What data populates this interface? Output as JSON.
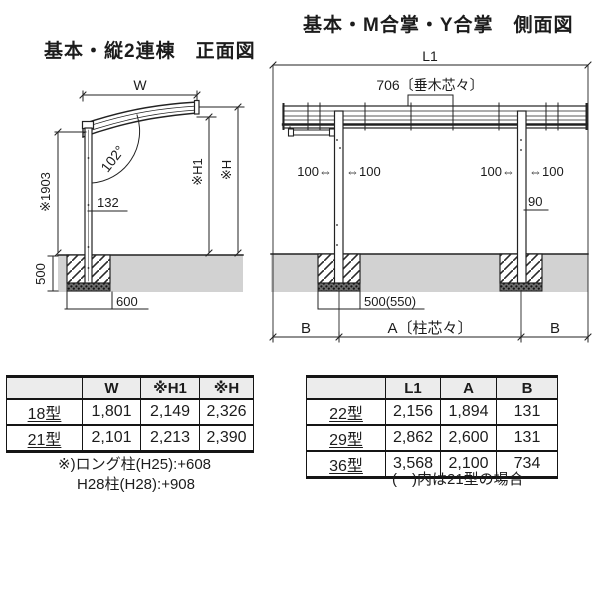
{
  "front_view": {
    "title": "基本・縦2連棟　正面図",
    "labels": {
      "width": "W",
      "angle": "102°",
      "post_height": "※1903",
      "offset132": "132",
      "h1": "※H1",
      "h": "※H",
      "depth500": "500",
      "footing600": "600"
    }
  },
  "side_view": {
    "title": "基本・M合掌・Y合掌　側面図",
    "labels": {
      "l1": "L1",
      "rafter_pitch": "706〔垂木芯々〕",
      "post_left_out": "100⇔",
      "post_left_in": "⇔100",
      "post_right_out": "100⇔",
      "post_right_in": "⇔100",
      "beam90": "90",
      "footing": "500(550)",
      "b_left": "B",
      "a_span": "A〔柱芯々〕",
      "b_right": "B"
    }
  },
  "size_table_front": {
    "headers": [
      "",
      "W",
      "※H1",
      "※H"
    ],
    "rows": [
      {
        "label": "18型",
        "values": [
          "1,801",
          "2,149",
          "2,326"
        ]
      },
      {
        "label": "21型",
        "values": [
          "2,101",
          "2,213",
          "2,390"
        ]
      }
    ],
    "notes": [
      "※)ロング柱(H25):+608",
      "H28柱(H28):+908"
    ]
  },
  "size_table_side": {
    "headers": [
      "",
      "L1",
      "A",
      "B"
    ],
    "rows": [
      {
        "label": "22型",
        "values": [
          "2,156",
          "1,894",
          "131"
        ]
      },
      {
        "label": "29型",
        "values": [
          "2,862",
          "2,600",
          "131"
        ]
      },
      {
        "label": "36型",
        "values": [
          "3,568",
          "2,100",
          "734"
        ]
      }
    ],
    "note": "(　)内は21型の場合"
  },
  "colors": {
    "line": "#222222",
    "ground": "#d2d2d2",
    "table_header_bg": "#ececec"
  }
}
